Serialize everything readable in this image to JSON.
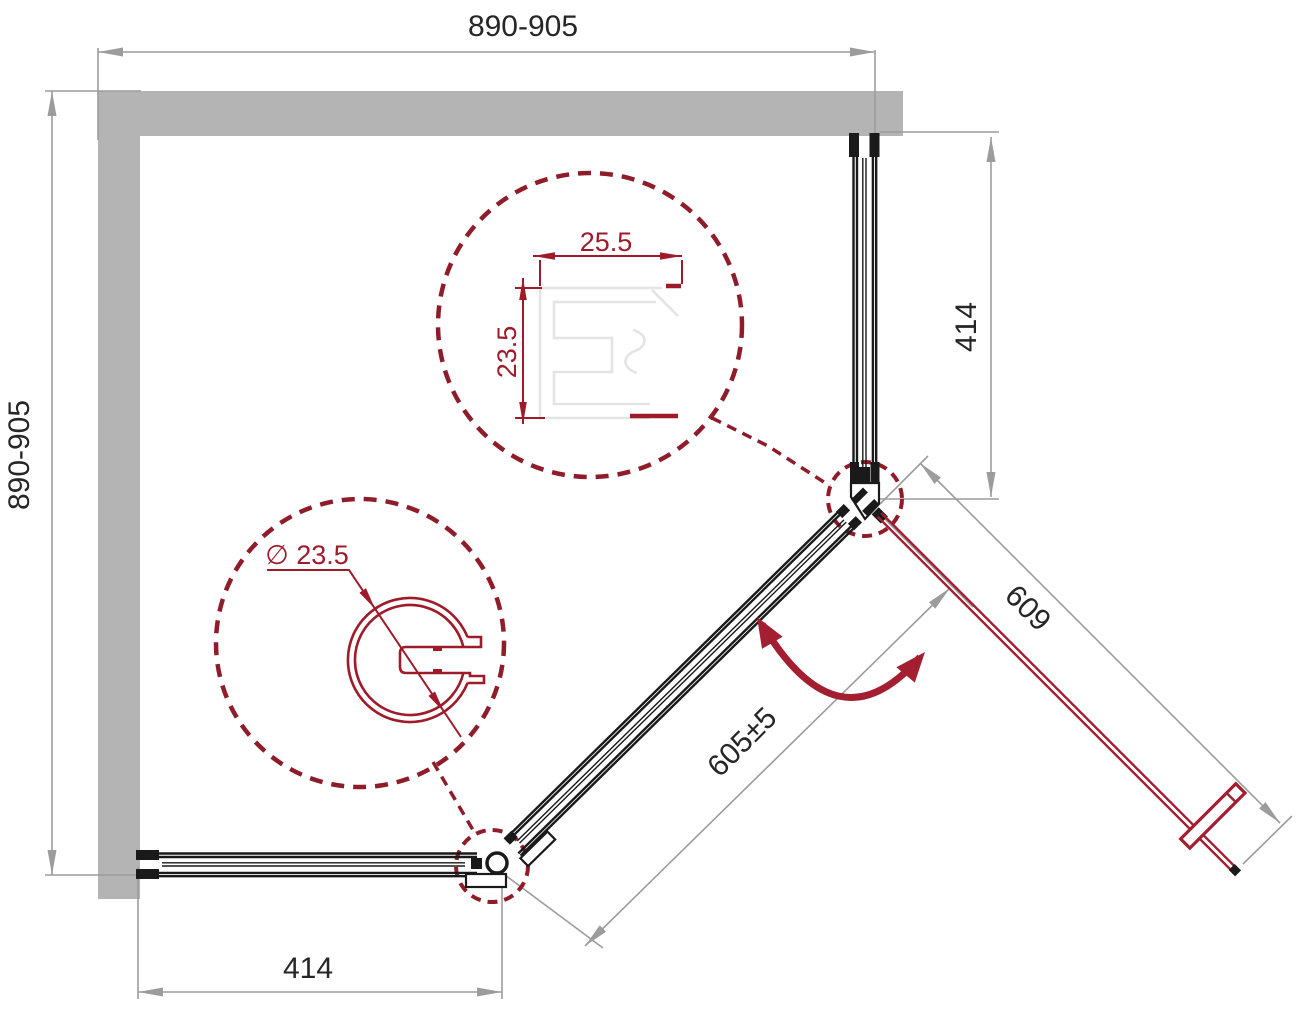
{
  "drawing": {
    "type": "shower enclosure corner-entry plan view technical drawing",
    "dims": {
      "top_width": "890-905",
      "left_height": "890-905",
      "right_panel": "414",
      "bottom_panel": "414",
      "door_width": "605±5",
      "door_open": "609",
      "profile_width": "25.5",
      "profile_height": "23.5",
      "profile_diameter": "∅ 23.5"
    }
  },
  "colors": {
    "wall_gray": "#b4b4b4",
    "dim_gray": "#9c9c9c",
    "drawing_black": "#1a1a1a",
    "accent_red": "#a41e31",
    "maroon_dashed": "#8f1c29",
    "detail_red": "#9e1b2a",
    "profile_light": "#e4e4e4",
    "text_dark": "#262626"
  }
}
